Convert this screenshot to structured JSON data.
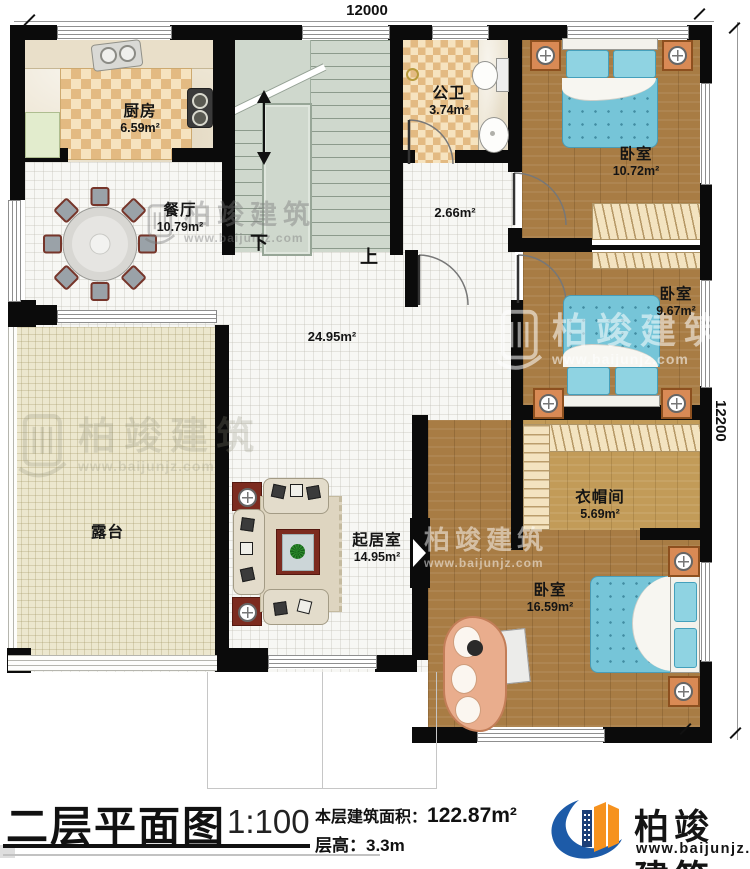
{
  "plan": {
    "dim_top": "12000",
    "dim_right": "12200",
    "stairs": {
      "down": "下",
      "up": "上"
    },
    "rooms": {
      "kitchen": {
        "name": "厨房",
        "area": "6.59m²"
      },
      "dining": {
        "name": "餐厅",
        "area": "10.79m²"
      },
      "bath": {
        "name": "公卫",
        "area": "3.74m²"
      },
      "hall_small": {
        "area": "2.66m²"
      },
      "hall": {
        "area": "24.95m²"
      },
      "bedroom_top": {
        "name": "卧室",
        "area": "10.72m²"
      },
      "bedroom_mid": {
        "name": "卧室",
        "area": "9.67m²"
      },
      "cloakroom": {
        "name": "衣帽间",
        "area": "5.69m²"
      },
      "bedroom_master": {
        "name": "卧室",
        "area": "16.59m²"
      },
      "living": {
        "name": "起居室",
        "area": "14.95m²"
      },
      "terrace": {
        "name": "露台"
      }
    }
  },
  "titleblock": {
    "title": "二层平面图",
    "scale": "1:100",
    "area_label": "本层建筑面积：",
    "area_value": "122.87m²",
    "floor_height": "层高：3.3m"
  },
  "brand": {
    "name": "柏竣建筑",
    "url": "www.baijunjz.com"
  },
  "watermark": {
    "name": "柏竣建筑",
    "url": "www.baijunjz.com"
  },
  "colors": {
    "wall": "#000000",
    "wood": "#a87c44",
    "bed_blue": "#74c4d8",
    "logo_blue": "#1d5ba8",
    "logo_orange": "#f6921e"
  }
}
